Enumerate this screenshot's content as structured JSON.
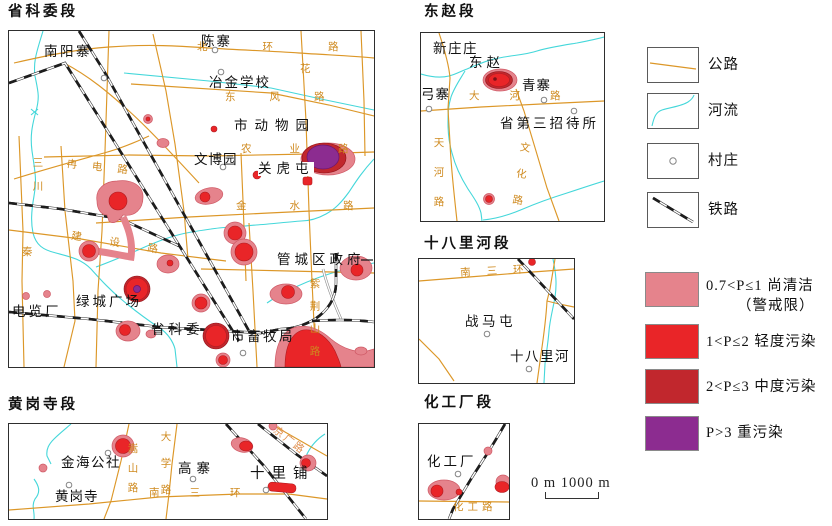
{
  "maps": {
    "m1": {
      "title": "省科委段",
      "places": {
        "nanyangzhai": "南阳寨",
        "chenzhai": "陈寨",
        "yejinxuexiao": "冶金学校",
        "shidongwuyuan": "市动物园",
        "wenboyuan": "文博园",
        "guanhutun": "关虎屯",
        "guanchengquzhengfu": "管城区政府",
        "dianlanchang": "电览厂",
        "lvchengguangchang": "绿城广场",
        "shengkewei": "省科委",
        "shixumuju": "市畜牧局"
      },
      "roads": {
        "beihuanlu": "北环路",
        "dongfenglu": "东风路",
        "nongyelu": "农业路",
        "jinshuilu": "金水路",
        "jianshelu": "建设路",
        "randianlu": "冉电路",
        "sanchuan": "三川",
        "qin": "秦",
        "hua": "花",
        "zijingshanlu": "紫荆山路"
      }
    },
    "m2": {
      "title": "东赵段",
      "places": {
        "xinzhuangzhuang": "新庄庄",
        "dongzhao": "东赵",
        "qingzhai": "青寨",
        "gongzhai": "弓寨",
        "zhaodaisuo": "省第三招待所"
      },
      "roads": {
        "dahelu": "大河路",
        "tianhelu": "天河路",
        "wenhualu": "文化路"
      }
    },
    "m3": {
      "title": "十八里河段",
      "places": {
        "zhanmatun": "战马屯",
        "shibalihe": "十八里河"
      },
      "roads": {
        "nansanhuan": "南三环"
      }
    },
    "m4": {
      "title": "黄岗寺段",
      "places": {
        "jinhaigongshe": "金海公社",
        "huanggangsi": "黄岗寺",
        "gaozhai": "高寨",
        "shilipu": "十里铺"
      },
      "roads": {
        "daxuelu": "大学路",
        "nansanhuan": "南三环",
        "songshanlu": "嵩山路",
        "jingguanglu": "京广路"
      }
    },
    "m5": {
      "title": "化工厂段",
      "places": {
        "huagongchang": "化工厂"
      },
      "roads": {
        "huagonglu": "化工路"
      }
    }
  },
  "legend": {
    "symbols": [
      {
        "id": "road",
        "label": "公路"
      },
      {
        "id": "river",
        "label": "河流"
      },
      {
        "id": "village",
        "label": "村庄"
      },
      {
        "id": "railway",
        "label": "铁路"
      }
    ],
    "classes": [
      {
        "label": "0.7<P≤1 尚清洁",
        "label2": "（警戒限）",
        "color": "#e5838c",
        "meaning": "尚清洁(警戒限)"
      },
      {
        "label": "1<P≤2 轻度污染",
        "color": "#e92528",
        "meaning": "轻度污染"
      },
      {
        "label": "2<P≤3 中度污染",
        "color": "#c1272d",
        "meaning": "中度污染"
      },
      {
        "label": "P>3 重污染",
        "color": "#8c2c90",
        "meaning": "重污染"
      }
    ]
  },
  "scalebar": {
    "label": "0 m 1000 m"
  },
  "colors": {
    "road": "#dc9728",
    "road_label": "#cf8a1f",
    "river": "#44d7da",
    "railway": "#2b2b2b",
    "pink_slight": "#e5838c",
    "red_light": "#e92528",
    "darkred_moderate": "#c1272d",
    "purple_heavy": "#8c2c90"
  }
}
